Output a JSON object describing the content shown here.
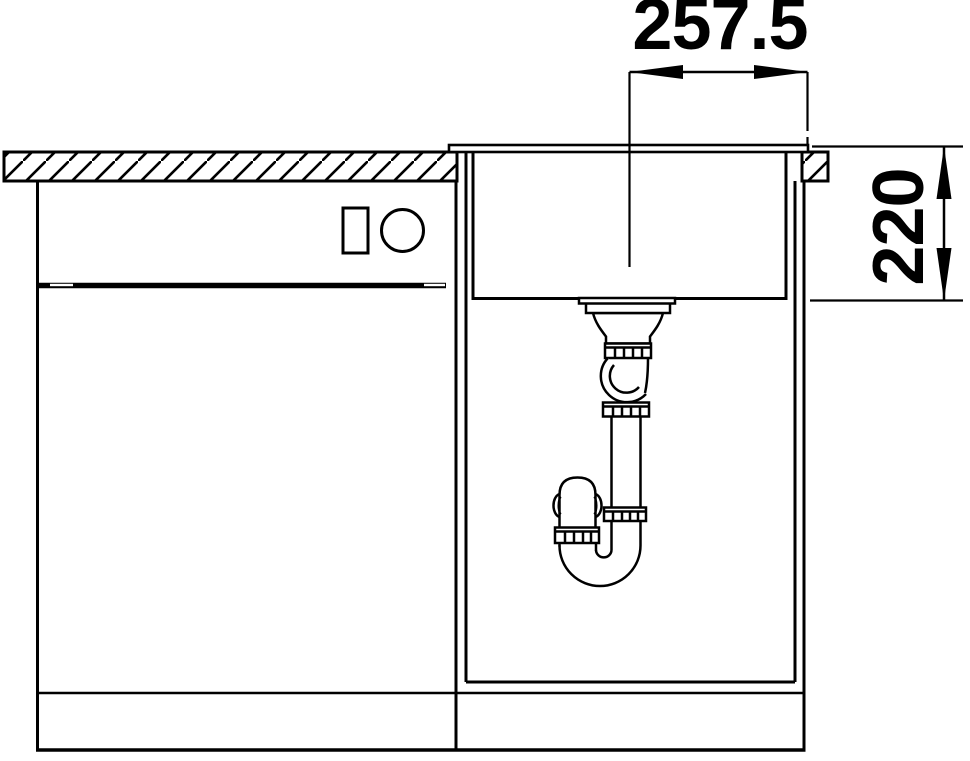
{
  "diagram": {
    "type": "sink-installation-technical-drawing",
    "background_color": "#ffffff",
    "line_color": "#000000",
    "dimension_labels": {
      "drain_offset": "257.5",
      "bowl_depth": "220"
    }
  }
}
